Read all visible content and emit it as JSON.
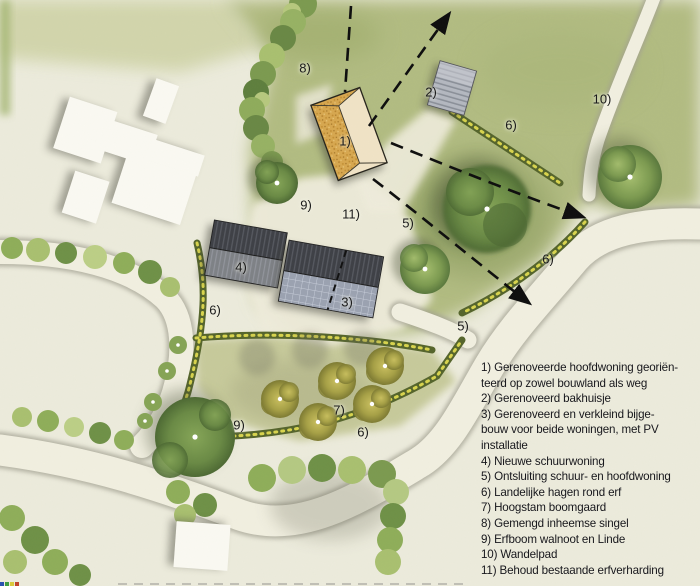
{
  "plan_labels": [
    {
      "ref": "8",
      "text": "8)"
    },
    {
      "ref": "2",
      "text": "2)"
    },
    {
      "ref": "10",
      "text": "10)"
    },
    {
      "ref": "6",
      "text": "6)"
    },
    {
      "ref": "1",
      "text": "1)"
    },
    {
      "ref": "9",
      "text": "9)"
    },
    {
      "ref": "11",
      "text": "11)"
    },
    {
      "ref": "5",
      "text": "5)"
    },
    {
      "ref": "6",
      "text": "6)"
    },
    {
      "ref": "4",
      "text": "4)"
    },
    {
      "ref": "3",
      "text": "3)"
    },
    {
      "ref": "6",
      "text": "6)"
    },
    {
      "ref": "5",
      "text": "5)"
    },
    {
      "ref": "7",
      "text": "7)"
    },
    {
      "ref": "9",
      "text": "9)"
    },
    {
      "ref": "6",
      "text": "6)"
    }
  ],
  "legend": {
    "lines": [
      "1) Gerenoveerde hoofdwoning georiën-",
      "teerd op zowel bouwland als weg",
      "2) Gerenoveerd bakhuisje",
      "3) Gerenoveerd en verkleind bijge-",
      "bouw voor beide woningen, met PV",
      "installatie",
      "4) Nieuwe schuurwoning",
      "5) Ontsluiting schuur- en hoofdwoning",
      "6) Landelijke hagen rond erf",
      "7) Hoogstam boomgaard",
      "8) Gemengd inheemse singel",
      "9) Erfboom walnoot en Linde",
      "10) Wandelpad",
      "11) Behoud bestaande erfverharding"
    ]
  },
  "colors": {
    "parchment": "#ecebdc",
    "grass": "#b2bc82",
    "road": "#f1efe0",
    "hedge_green": "#55652c",
    "hedge_yellow": "#d8d44e",
    "tree_green": "#6a8a45",
    "orchard_tree": "#a6a046",
    "roof_thatch": "#d9a851",
    "roof_light": "#f0e3c6",
    "roof_slate_dark": "#3e4046",
    "roof_slate_mid": "#7e8186",
    "pv_panels": "#9ba2b1",
    "bakehouse_gray": "#b4b8c0",
    "existing_building": "#faf9f2",
    "arrow": "#0e0e0e",
    "text": "#17171c"
  }
}
